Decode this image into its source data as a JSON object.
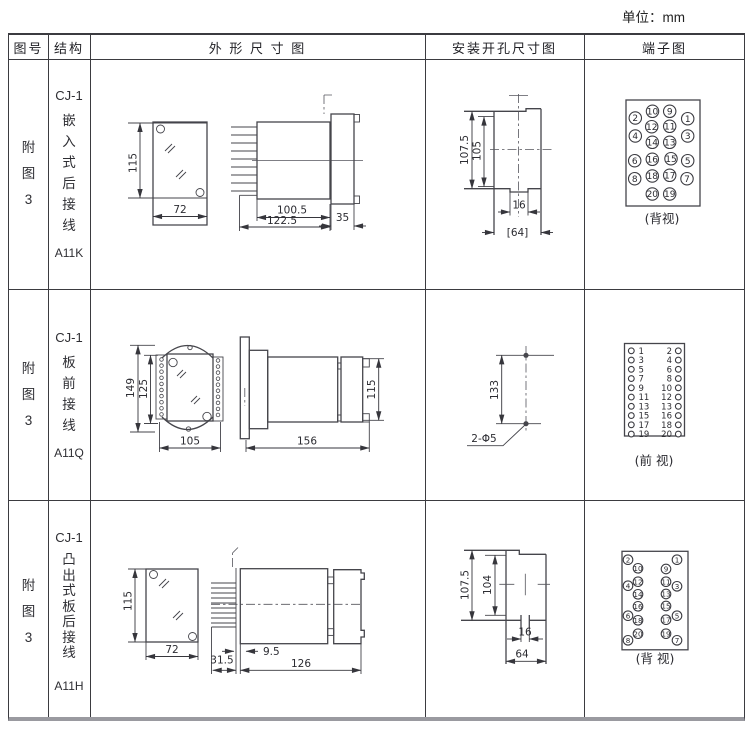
{
  "unit_label": "单位：mm",
  "table": {
    "headers": [
      "图号",
      "结构",
      "外 形 尺 寸 图",
      "安装开孔尺寸图",
      "端子图"
    ],
    "rows": [
      {
        "fig_chars": [
          "附",
          "图",
          "3"
        ],
        "model": "CJ-1",
        "struct_chars": [
          "嵌",
          "入",
          "式",
          "后",
          "接",
          "线"
        ],
        "code": "A11K",
        "outline_dims": {
          "height": "115",
          "width": "72",
          "depth": "100.5",
          "total_depth": "122.5",
          "flange": "35"
        },
        "mount_dims": {
          "cutout_h": "107.5",
          "cutout_h2": "105",
          "slot": "16",
          "width": "[64]"
        },
        "terminal_view_label": "(背视)"
      },
      {
        "fig_chars": [
          "附",
          "图",
          "3"
        ],
        "model": "CJ-1",
        "struct_chars": [
          "板",
          "前",
          "接",
          "线"
        ],
        "code": "A11Q",
        "outline_dims": {
          "height": "149",
          "inner_height": "125",
          "width": "105",
          "depth": "156",
          "rear_height": "115"
        },
        "mount_dims": {
          "pitch": "133",
          "holes": "2-Φ5"
        },
        "terminal_view_label": "(前 视)"
      },
      {
        "fig_chars": [
          "附",
          "图",
          "3"
        ],
        "model": "CJ-1",
        "struct_chars": [
          "凸",
          "出",
          "式",
          "板",
          "后",
          "接",
          "线"
        ],
        "code": "A11H",
        "outline_dims": {
          "height": "115",
          "width": "72",
          "pin_len": "31.5",
          "plate": "9.5",
          "depth": "126"
        },
        "mount_dims": {
          "cutout_h": "107.5",
          "cutout_h2": "104",
          "slot": "16",
          "width": "64"
        },
        "terminal_view_label": "(背 视)"
      }
    ]
  },
  "terminals": {
    "row1": {
      "r": 6.2,
      "fs": 9,
      "items": [
        {
          "n": "10",
          "x": 651.5,
          "y": 109.3
        },
        {
          "n": "9",
          "x": 668.7,
          "y": 109.3
        },
        {
          "n": "2",
          "x": 634.3,
          "y": 116
        },
        {
          "n": "1",
          "x": 686.7,
          "y": 116.7
        },
        {
          "n": "12",
          "x": 650.7,
          "y": 124.7
        },
        {
          "n": "11",
          "x": 668.7,
          "y": 124.3
        },
        {
          "n": "4",
          "x": 634.3,
          "y": 134
        },
        {
          "n": "3",
          "x": 686.7,
          "y": 134
        },
        {
          "n": "14",
          "x": 651.3,
          "y": 140.3
        },
        {
          "n": "13",
          "x": 668.7,
          "y": 140.3
        },
        {
          "n": "16",
          "x": 651.3,
          "y": 157.3
        },
        {
          "n": "15",
          "x": 670,
          "y": 156.7
        },
        {
          "n": "6",
          "x": 633.7,
          "y": 158.7
        },
        {
          "n": "5",
          "x": 686.7,
          "y": 158.7
        },
        {
          "n": "18",
          "x": 651.3,
          "y": 174
        },
        {
          "n": "17",
          "x": 668.7,
          "y": 173.3
        },
        {
          "n": "8",
          "x": 633.7,
          "y": 176.7
        },
        {
          "n": "7",
          "x": 686,
          "y": 176.7
        },
        {
          "n": "20",
          "x": 651.3,
          "y": 192
        },
        {
          "n": "19",
          "x": 668.7,
          "y": 192
        }
      ]
    },
    "row2": {
      "r": 2.9,
      "fs": 8.5,
      "y0": 348.8,
      "dy": 9.25,
      "lcx": 630.3,
      "lx": 637.5,
      "rx": 671,
      "rcx": 677.3,
      "rows": [
        {
          "l": "1",
          "r": "2"
        },
        {
          "l": "3",
          "r": "4"
        },
        {
          "l": "5",
          "r": "6"
        },
        {
          "l": "7",
          "r": "8"
        },
        {
          "l": "9",
          "r": "10"
        },
        {
          "l": "11",
          "r": "12"
        },
        {
          "l": "13",
          "r": "13"
        },
        {
          "l": "15",
          "r": "16"
        },
        {
          "l": "17",
          "r": "18"
        },
        {
          "l": "19",
          "r": "20"
        }
      ]
    },
    "row3": {
      "r": 4.8,
      "fs": 7.2,
      "items": [
        {
          "n": "2",
          "x": 627,
          "y": 557.7
        },
        {
          "n": "1",
          "x": 676,
          "y": 557.7
        },
        {
          "n": "10",
          "x": 637,
          "y": 566.3
        },
        {
          "n": "9",
          "x": 665,
          "y": 567
        },
        {
          "n": "12",
          "x": 637,
          "y": 579.7
        },
        {
          "n": "11",
          "x": 665,
          "y": 579.7
        },
        {
          "n": "4",
          "x": 627,
          "y": 583.7
        },
        {
          "n": "3",
          "x": 676,
          "y": 584.3
        },
        {
          "n": "14",
          "x": 637,
          "y": 592.3
        },
        {
          "n": "13",
          "x": 665,
          "y": 592
        },
        {
          "n": "16",
          "x": 637,
          "y": 604.3
        },
        {
          "n": "15",
          "x": 665,
          "y": 604
        },
        {
          "n": "6",
          "x": 627,
          "y": 613.7
        },
        {
          "n": "5",
          "x": 676,
          "y": 613.7
        },
        {
          "n": "18",
          "x": 637,
          "y": 618.3
        },
        {
          "n": "17",
          "x": 665,
          "y": 617.7
        },
        {
          "n": "20",
          "x": 637,
          "y": 631.7
        },
        {
          "n": "19",
          "x": 665,
          "y": 631.7
        },
        {
          "n": "8",
          "x": 627,
          "y": 638.3
        },
        {
          "n": "7",
          "x": 676,
          "y": 638.3
        }
      ]
    }
  }
}
